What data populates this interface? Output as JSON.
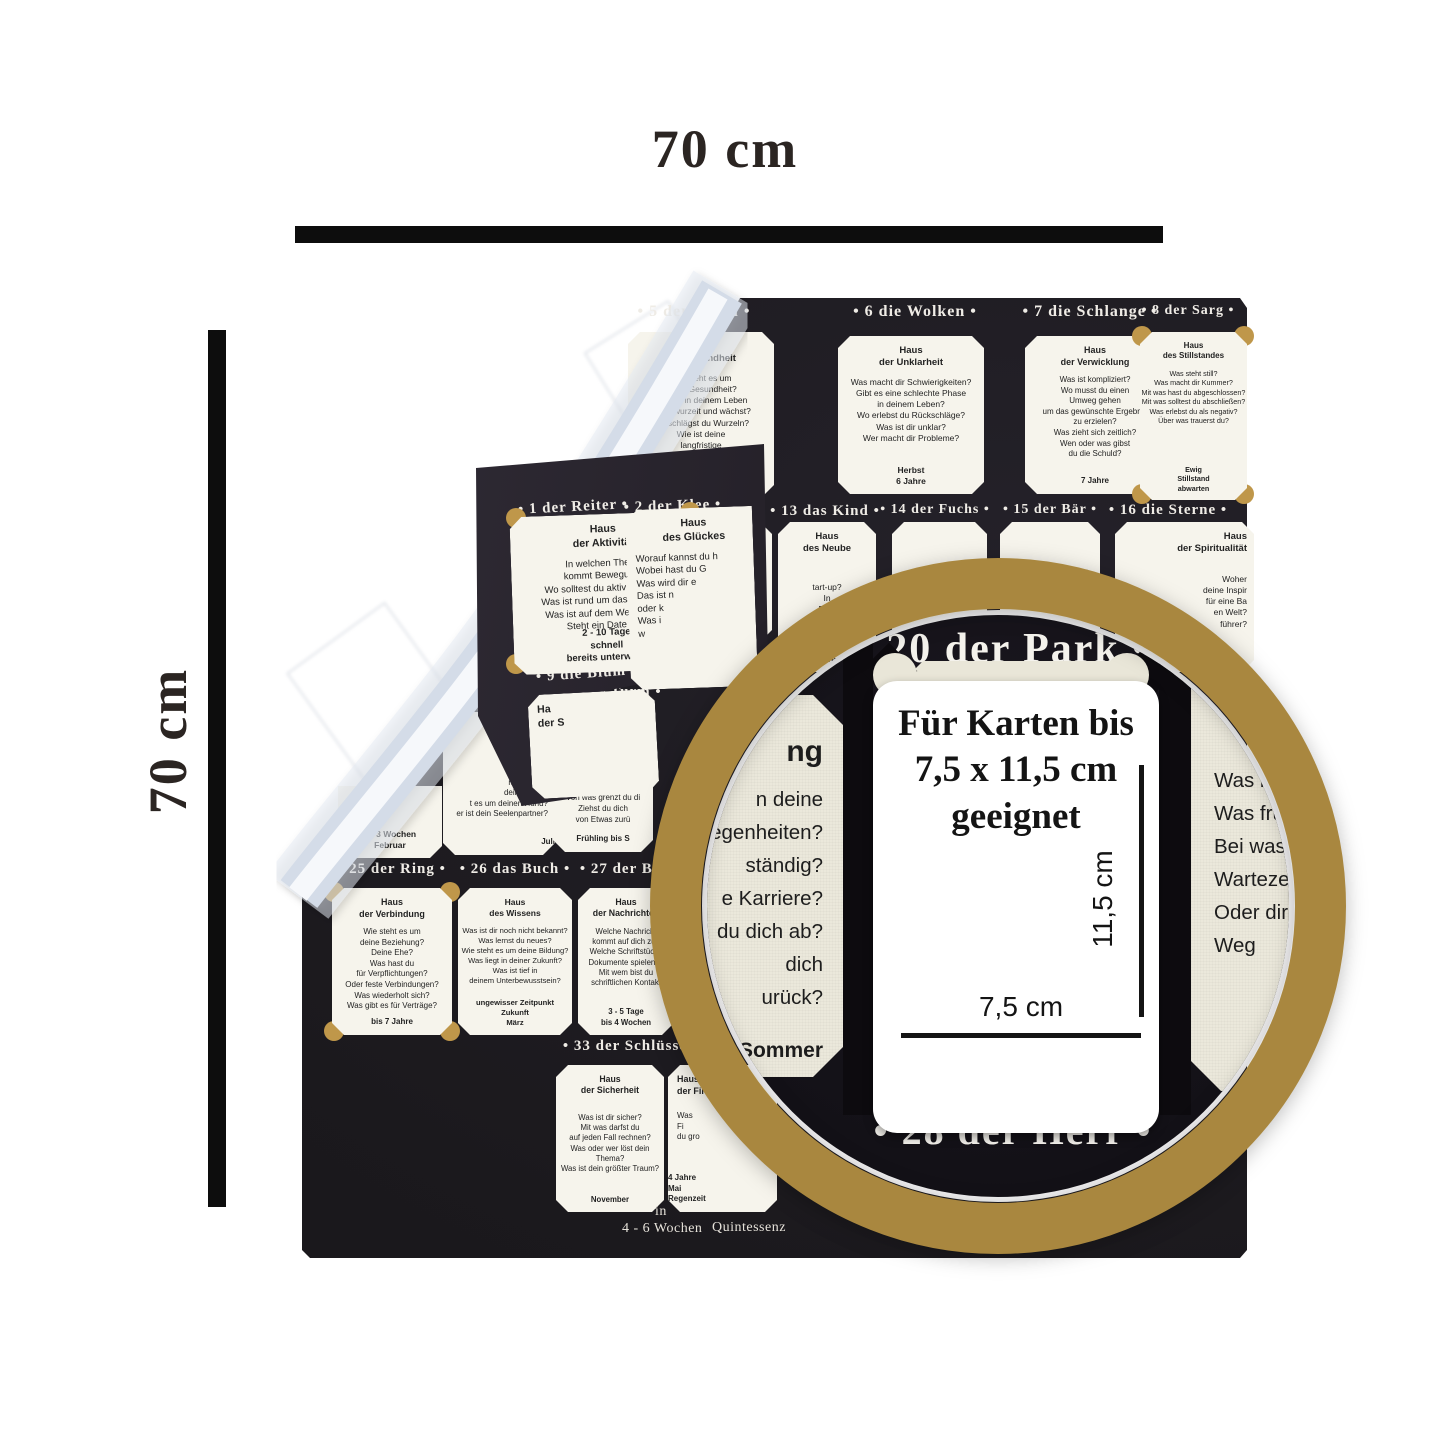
{
  "annotations": {
    "top_width": "70 cm",
    "left_height": "70 cm"
  },
  "colors": {
    "gold": "#a9873f",
    "cloth": "#1b191d",
    "card": "#f6f4ec"
  },
  "magnifier": {
    "top_header": "• 20 der Park •",
    "bottom_header": "• 28 der Herr •",
    "note": "Für Karten bis\n7,5 x 11,5 cm\ngeeignet",
    "width_label": "7,5 cm",
    "height_label": "11,5 cm",
    "watermark": "arts of C",
    "left_card": {
      "header_fragment": "ng",
      "lines": "n deine\nelegenheiten?\nständig?\ne Karriere?\ndu dich ab?\ndich\nurück?",
      "bottom_fragment": "is Sommer"
    },
    "right_card": {
      "header_fragment": "des",
      "lines": "Was blockier\nWas frus\nBei was\nWartezeit\nOder dir e\nWeg",
      "bottom_fragment": "b"
    }
  },
  "cloth": {
    "headers": {
      "h5": "• 5 der Baum •",
      "h6": "• 6 die Wolken •",
      "h7": "• 7 die Schlange •",
      "h8": "• 8 der Sarg •",
      "h1": "• 1 der Reiter •",
      "h2": "• 2 der Klee •",
      "h12": "n •",
      "h13": "• 13 das Kind •",
      "h14": "• 14 der Fuchs •",
      "h15": "• 15 der Bär •",
      "h16": "• 16 die Sterne •",
      "h9": "• 9 die Blum",
      "h19": "9 der Turm •",
      "h25": "• 25 der Ring •",
      "h26": "• 26 das Buch •",
      "h27": "• 27 der Brief •",
      "h33": "• 33 der Schlüssel •"
    },
    "cards": {
      "baum5": {
        "house": "Haus\nder Gesundheit",
        "lines": "Wie steht es um\ndeine Gesundheit?\nWas ist in deinem Leben\nist verwurzelt und wächst?\nWo schlägst du Wurzeln?\nWie ist deine\nlangfristige\nLebensentwicklung?",
        "footer": "Weihnachten\n9 - 12 Monate\n5 - 10 Jahre"
      },
      "wolken6": {
        "house": "Haus\nder Unklarheit",
        "lines": "Was macht dir Schwierigkeiten?\nGibt es eine schlechte Phase\nin deinem Leben?\nWo erlebst du Rückschläge?\nWas ist dir unklar?\nWer macht dir Probleme?",
        "footer": "Herbst\n6 Jahre"
      },
      "schlange7": {
        "house": "Haus\nder Verwicklung",
        "lines": "Was ist kompliziert?\nWo musst du einen\nUmweg gehen\num das gewünschte Ergebnis\nzu erzielen?\nWas zieht sich zeitlich?\nWen oder was gibst\ndu die Schuld?",
        "footer": "7 Jahre"
      },
      "sarg8": {
        "house": "Haus\ndes Stillstandes",
        "lines": "Was steht still?\nWas macht dir Kummer?\nMit was hast du abgeschlossen?\nMit was solltest du abschließen?\nWas erlebst du als negativ?\nÜber was trauerst du?",
        "footer": "Ewig\nStillstand\nabwarten"
      },
      "reiter1": {
        "house": "Haus\nder Aktivität",
        "lines": "In welchen Thema\nkommt Bewegung?\nWo solltest du aktiv werden?\nWas ist rund um das Auto los?\nWas ist auf dem Weg zu dir?\nSteht ein Date an?",
        "footer": "2 - 10 Tage\nschnell\nbereits unterwegs"
      },
      "klee2": {
        "house": "Haus\ndes Glückes",
        "lines": "Worauf kannst du h\nWobei hast du G\nWas wird dir e\nDas ist n\noder k\nWas i\nw"
      },
      "blumen9": {
        "house": "Ha\nder S"
      },
      "eulen12": {
        "house": "us\nervosität",
        "lines": "kommt ein Anruf?\ns stresst dich?\nlchen Kummer\nst du dir selbst\nredet über d"
      },
      "kind13": {
        "house": "Haus\ndes Neube",
        "lines": "tart-up?\nIn\nBegi",
        "footer": "chen\nahre"
      },
      "fuchs14": {
        "lines": "Für was ist\nder falsche Zeit\nW"
      },
      "baer15": {
        "lines": "Welches alte Thema\nschlimmer noch?"
      },
      "sterne16": {
        "house": "Haus\nder Spiritualität",
        "lines": "Woher\ndeine Inspir\nfür eine Ba\nen Welt?\nführer?"
      },
      "stoerche17": {
        "footer": "2 - 3 Wochen\nFebruar"
      },
      "hund18": {
        "lines": "haft?\nt dich?\nist dir treu?\nmmt neues\ndein Leben?\nt es um deinen Hund?\ner ist dein Seelenpartner?",
        "footer": "Juli"
      },
      "turm19": {
        "house": "Haus\nder Abgrenzung",
        "lines": "Wie steht es um deine\nbehördlichen Angelegenhe\nBist du selbstständig\nWas macht deine Kar\nVon was grenzt du di\nZiehst du dich\nvon Etwas zurü",
        "footer": "Frühling bis S"
      },
      "ring25": {
        "house": "Haus\nder Verbindung",
        "lines": "Wie steht es um\ndeine Beziehung?\nDeine Ehe?\nWas hast du\nfür Verpflichtungen?\nOder feste Verbindungen?\nWas wiederholt sich?\nWas gibt es für Verträge?",
        "footer": "bis 7 Jahre"
      },
      "buch26": {
        "house": "Haus\ndes Wissens",
        "lines": "Was ist dir noch nicht bekannt?\nWas lernst du neues?\nWie steht es um deine Bildung?\nWas liegt in deiner Zukunft?\nWas ist tief in\ndeinem Unterbewusstsein?",
        "footer": "ungewisser Zeitpunkt\nZukunft\nMärz"
      },
      "brief27": {
        "house": "Haus\nder Nachrichten",
        "lines": "Welche Nachricht\nkommt auf dich zu?\nWelche Schriftstücke\nDokumente spielen ei\nMit wem bist du\nschriftlichen Kontakt",
        "footer": "3 - 5 Tage\nbis 4 Wochen"
      },
      "schluessel33": {
        "house": "Haus\nder Sicherheit",
        "lines": "Was ist dir sicher?\nMit was darfst du\nauf jeden Fall rechnen?\nWas oder wer löst dein Thema?\nWas ist dein größter Traum?",
        "footer": "November"
      },
      "fische34": {
        "house": "Haus\nder Finanzen",
        "lines": "Was\nFi\ndu gro",
        "footer": "4 Jahre\nMai\nRegenzeit"
      }
    },
    "notes": {
      "in": "in",
      "weeks": "4 - 6 Wochen",
      "quint": "Quintessenz"
    }
  }
}
